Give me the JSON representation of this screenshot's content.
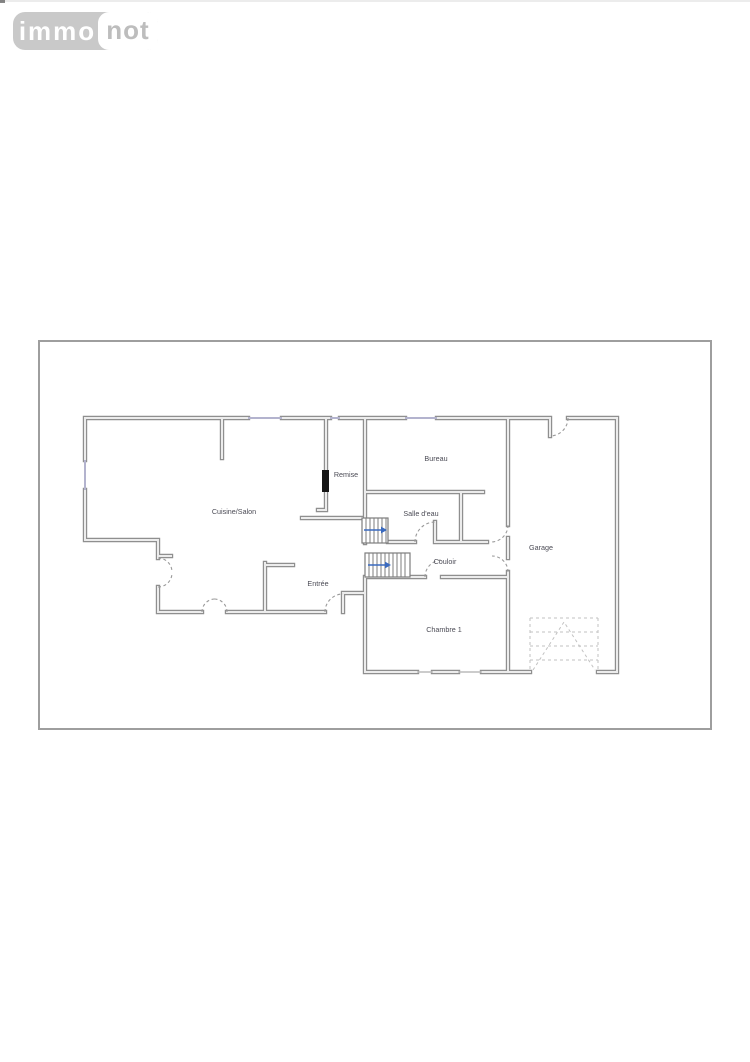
{
  "logo": {
    "brand_left": "immo",
    "brand_right": "not"
  },
  "floor_plan": {
    "rooms": [
      {
        "label": "Cuisine/Salon"
      },
      {
        "label": "Remise"
      },
      {
        "label": "Bureau"
      },
      {
        "label": "Salle d'eau"
      },
      {
        "label": "Couloir"
      },
      {
        "label": "Garage"
      },
      {
        "label": "Entrée"
      },
      {
        "label": "Chambre 1"
      }
    ],
    "colors": {
      "wall": "#8f8f8f",
      "wall_core": "#ececec",
      "window": "#b3b3ce",
      "stair_arrow": "#3a6abf",
      "door_arc": "#9a9a9a",
      "garage_door_dashed": "#c2c2c2",
      "label_text": "#4b4b55",
      "frame_border": "#9e9e9e",
      "logo_bg": "#c9c9c9",
      "logo_not_text": "#bdbdbd"
    }
  }
}
